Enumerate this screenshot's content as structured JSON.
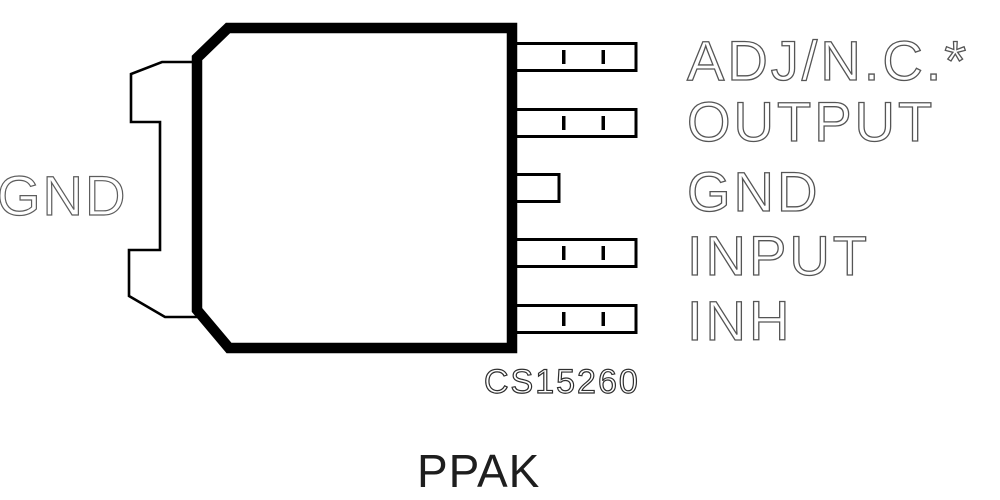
{
  "figure": {
    "package_name": "PPAK",
    "drawing_code": "CS15260",
    "tab_label": "GND",
    "pins": [
      {
        "label": "ADJ/N.C.*"
      },
      {
        "label": "OUTPUT"
      },
      {
        "label": "GND"
      },
      {
        "label": "INPUT"
      },
      {
        "label": "INH"
      }
    ],
    "colors": {
      "package_outline": "#000000",
      "label_stroke_gray": "#555555",
      "drawing_code_color": "#2f2f2f",
      "package_name_color": "#1e1e1e",
      "background": "#ffffff"
    }
  }
}
